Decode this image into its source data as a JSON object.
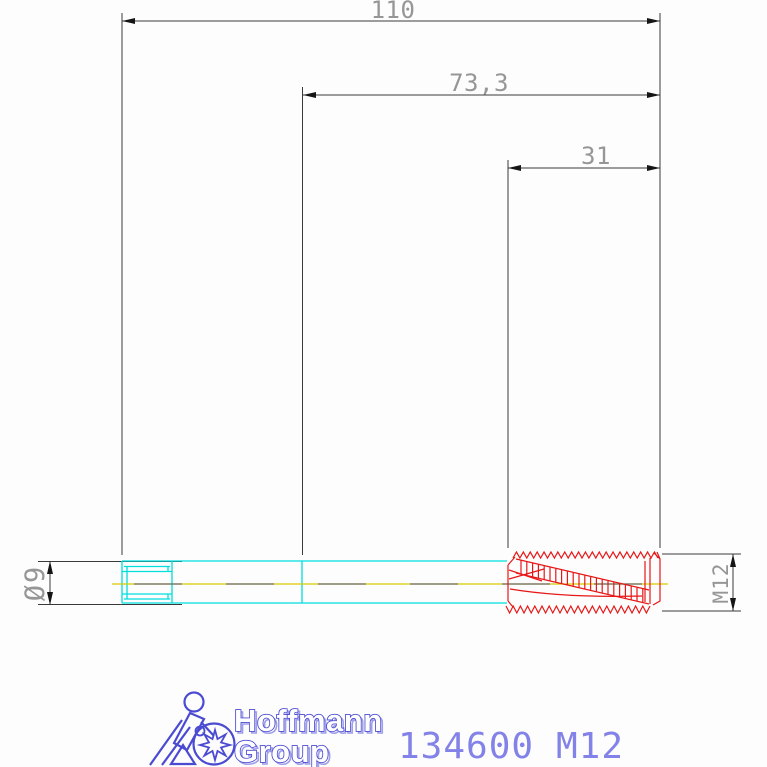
{
  "drawing": {
    "dim_overall_length": "110",
    "dim_intermediate_length": "73,3",
    "dim_thread_length": "31",
    "dim_shank_diameter": "Ø9",
    "dim_thread_size": "M12"
  },
  "footer": {
    "brand_line1": "Hoffmann",
    "brand_line2": "Group",
    "article_number": "134600",
    "article_size": "M12"
  },
  "colors": {
    "outline": "#3a3a3a",
    "arrow": "#151515",
    "dim_text": "#969696",
    "shank_cyan": "#00dede",
    "centerline_yellow": "#d8ca00",
    "centerline_dash": "#6a6a6a",
    "thread_red": "#e81717",
    "brand_blue": "#4a4ad2",
    "brand_shadow": "#a0a0ea",
    "article_blue": "#8282e8"
  }
}
